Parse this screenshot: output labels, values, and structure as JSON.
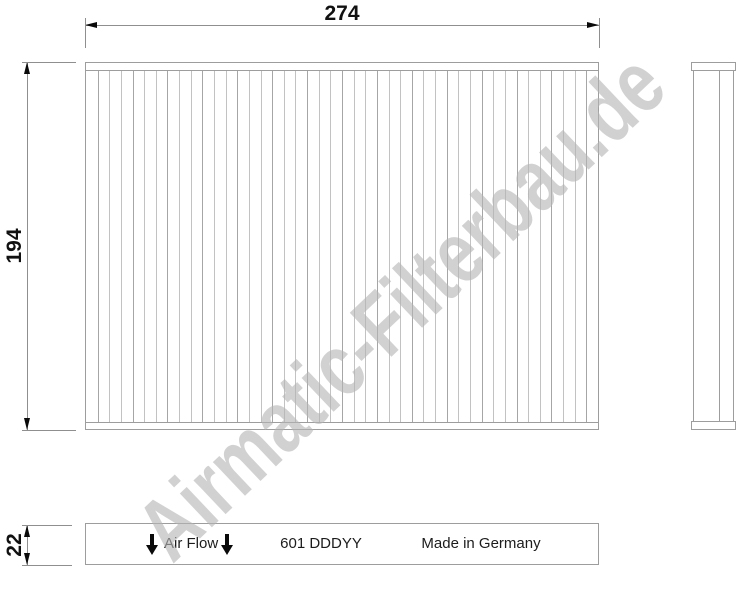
{
  "watermark": {
    "text": "Airmatic-Filterbau.de"
  },
  "dimensions": {
    "width_mm": "274",
    "height_mm": "194",
    "depth_mm": "22"
  },
  "views": {
    "top_view": {
      "pleat_lines": 43
    },
    "end_view": {
      "air_flow_label": "Air Flow",
      "part_number": "601 DDDYY",
      "made_in": "Made in Germany"
    }
  },
  "colors": {
    "line": "#9d9d9d",
    "pleat": "#c2c2c2",
    "pleat-dark": "#a6a6a6",
    "dim-line": "#8f8f8f",
    "arrow": "#0a0a0a",
    "text": "#111111",
    "strip-text": "#1c1c1c",
    "watermark": "#b5b5b5"
  }
}
